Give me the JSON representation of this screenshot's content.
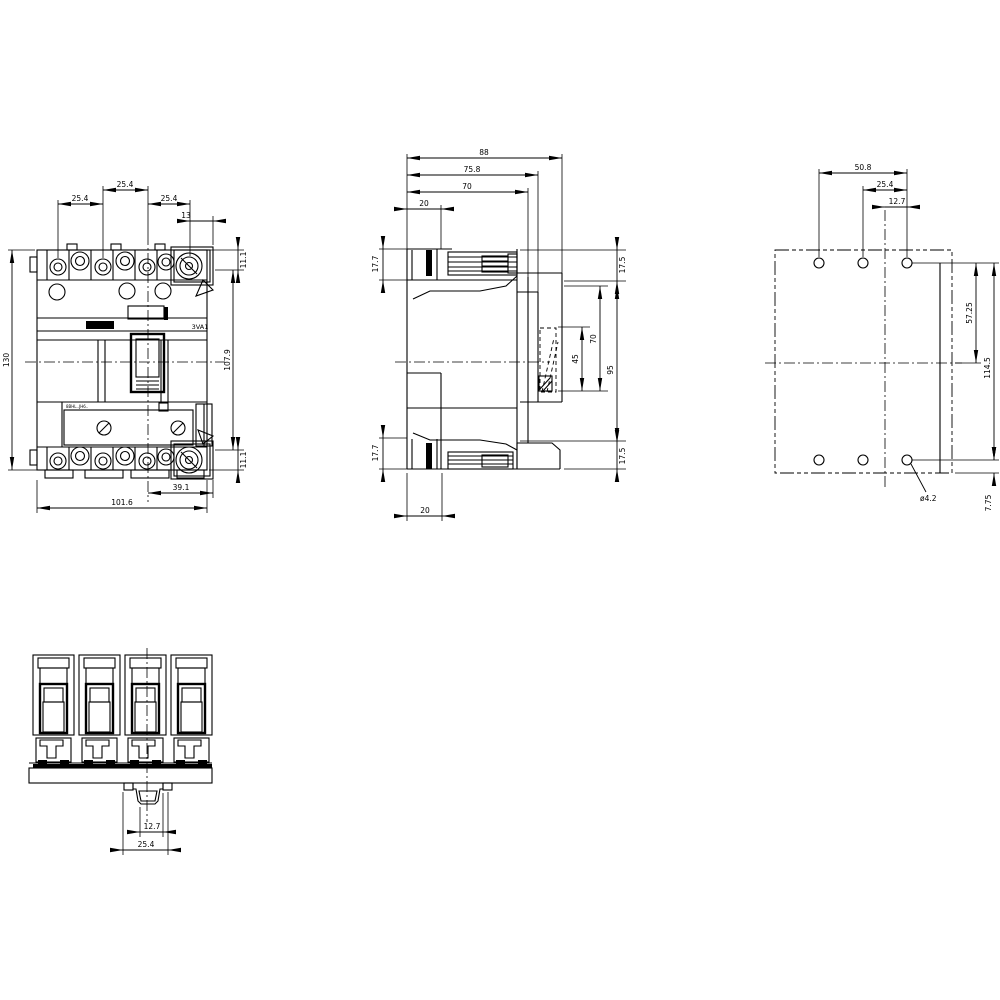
{
  "drawing": {
    "product_label": "3VA1",
    "accessory_code": "8BHL..JH6..",
    "line_color": "#000000",
    "background": "#ffffff",
    "front": {
      "dims": {
        "pitch_top": "25.4",
        "pitch_left": "25.4",
        "pitch_right": "25.4",
        "rotary_offset": "13",
        "step_top": "11.1",
        "height": "130",
        "inner_height": "107.9",
        "step_bottom": "11.1",
        "lower_width": "39.1",
        "width": "101.6"
      }
    },
    "side": {
      "dims": {
        "depth": "88",
        "cover_depth": "75.8",
        "body_depth": "70",
        "rail_top": "20",
        "term_top": "17.7",
        "term_bottom": "17.7",
        "rail_bottom": "20",
        "cap_top": "17.5",
        "span45": "45",
        "span70": "70",
        "span95": "95",
        "cap_bottom": "17.5"
      }
    },
    "rear": {
      "dims": {
        "span_h": "50.8",
        "pitch_h": "25.4",
        "half_h": "12.7",
        "half_v": "57.25",
        "span_v": "114.5",
        "edge": "7.75",
        "hole": "ø4.2"
      }
    },
    "bottom": {
      "dims": {
        "inner": "12.7",
        "outer": "25.4"
      }
    }
  }
}
